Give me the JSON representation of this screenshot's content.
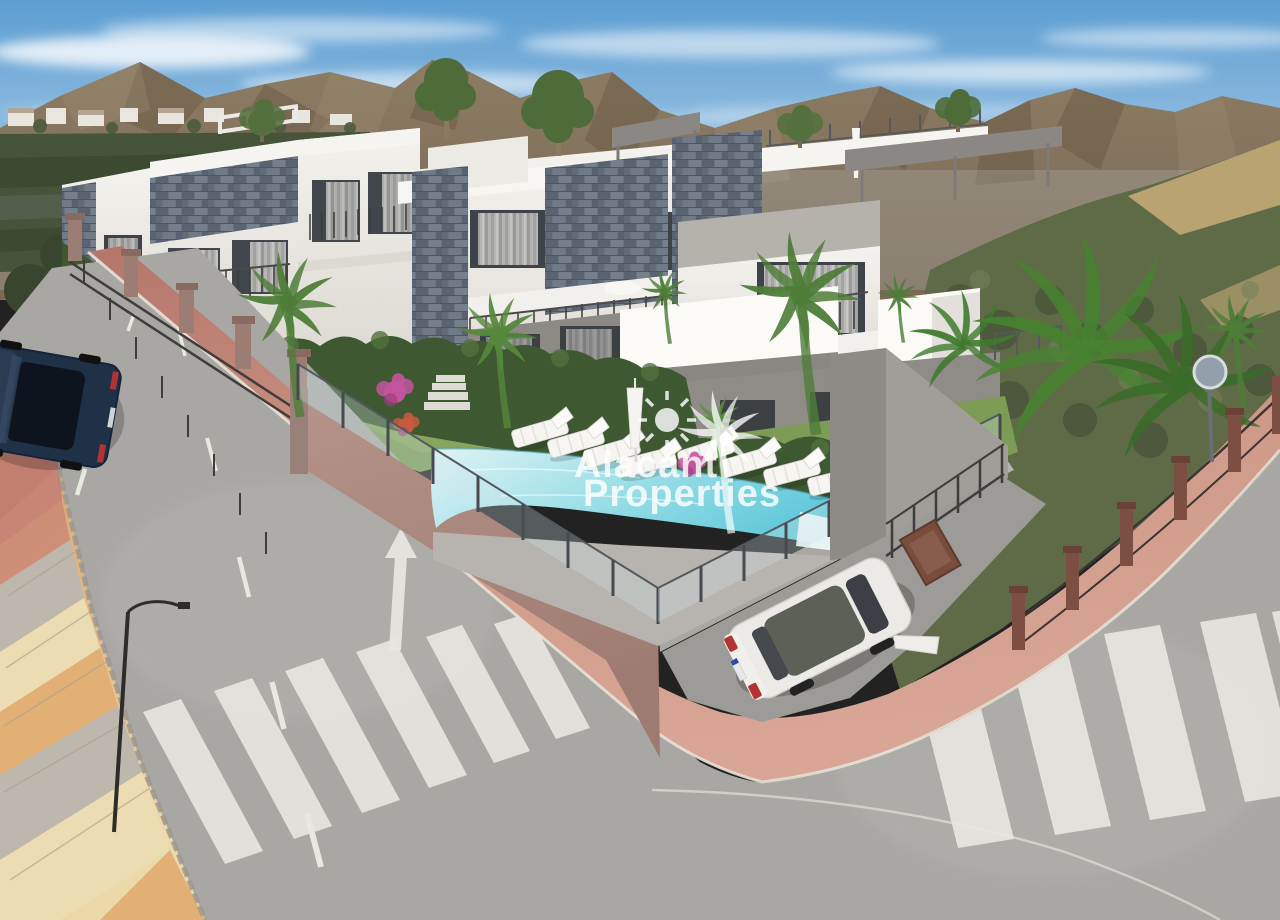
{
  "meta": {
    "type": "architectural-render-photo",
    "description": "Aerial 3D render of a new-build modern apartment complex on a street corner with communal pool, palm garden, glass pool fence, two zebra crossings and a mountain backdrop",
    "dimensions": "1280x920"
  },
  "watermark": {
    "line1": "Alacant",
    "line2": "Properties",
    "color": "#ffffff",
    "logo_icons": [
      "sun-icon",
      "palm-tree-icon"
    ]
  },
  "palette": {
    "sky_top": "#5d9ed2",
    "sky_horizon": "#e3edf5",
    "cloud": "#ffffff",
    "mountain": "#7e6d56",
    "mountain_shadow": "#5d4e3a",
    "field_green": "#46543a",
    "hill_scrub": "#5f6a47",
    "sand": "#c3aa76",
    "building_white": "#f2f0ec",
    "building_shadow": "#d2d0cb",
    "slate_stone": "#6a7380",
    "window": "#3e434a",
    "curtain": "#c9c8c5",
    "hedge": "#3e5832",
    "grass": "#7c9b55",
    "palm_green": "#4e7d38",
    "bougainvillea": "#c2559d",
    "pool_light": "#dff3f4",
    "pool_deep": "#57c5d7",
    "deck": "#b7b3ae",
    "wall_mauve": "#ad8b81",
    "wall_gray": "#a4a09b",
    "fence_metal": "#3f3d3b",
    "pillar_brown": "#7d4f42",
    "asphalt": "#a9a7a4",
    "marking": "#e9e7e1",
    "sidewalk_pink": "#c98d7d",
    "sidewalk_tan": "#e0ac6e",
    "curb": "#e7e2d7",
    "car_white": "#eceae7",
    "car_dark": "#1f3147",
    "taillight": "#b23333"
  },
  "scene": {
    "counts": {
      "apartment_blocks": 3,
      "sun_loungers": 8,
      "zebra_crossings": 2,
      "parked_cars": 2,
      "palm_trees": 6
    },
    "objects": [
      "sky",
      "clouds",
      "mountain-range",
      "hillside-village",
      "farm-fields",
      "scrub-hillside",
      "apartment-block-left",
      "apartment-block-center",
      "apartment-block-right",
      "roof-terrace",
      "communal-pool",
      "glass-pool-fence",
      "sun-loungers",
      "parasol",
      "garden-lawn",
      "hedges",
      "palm-trees",
      "banana-plants",
      "bougainvillea",
      "perimeter-wall",
      "metal-fence",
      "street-left",
      "street-right",
      "pink-sidewalk",
      "tiled-sidewalk",
      "zebra-crossing-left",
      "zebra-crossing-right",
      "lane-markings",
      "direction-arrow",
      "street-lamp",
      "traffic-sign-back",
      "parked-car-dark-blue",
      "parked-car-white",
      "driveway",
      "watermark"
    ]
  }
}
